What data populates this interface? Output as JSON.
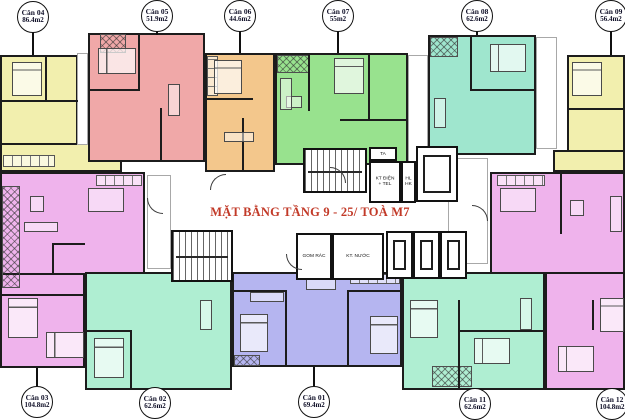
{
  "title": {
    "text": "MẶT BẰNG TẦNG 9 - 25/ TOÀ M7",
    "color": "#c23a28"
  },
  "apartments": [
    {
      "id": "can-04",
      "name": "Căn 04",
      "area": "86.4m2",
      "color": "#f2efae"
    },
    {
      "id": "can-05",
      "name": "Căn 05",
      "area": "51.9m2",
      "color": "#f0a8a8"
    },
    {
      "id": "can-06",
      "name": "Căn 06",
      "area": "44.6m2",
      "color": "#f3c78c"
    },
    {
      "id": "can-07",
      "name": "Căn 07",
      "area": "55m2",
      "color": "#98e28e"
    },
    {
      "id": "can-08",
      "name": "Căn 08",
      "area": "62.6m2",
      "color": "#9fe6ce"
    },
    {
      "id": "can-09",
      "name": "Căn 09",
      "area": "56.4m2",
      "color": "#f2efae"
    },
    {
      "id": "can-03",
      "name": "Căn 03",
      "area": "104.8m2",
      "color": "#efb3ec"
    },
    {
      "id": "can-02",
      "name": "Căn 02",
      "area": "62.6m2",
      "color": "#afeed2"
    },
    {
      "id": "can-01",
      "name": "Căn 01",
      "area": "69.4m2",
      "color": "#b5b5f0"
    },
    {
      "id": "can-11",
      "name": "Căn 11",
      "area": "62.6m2",
      "color": "#afeed2"
    },
    {
      "id": "can-12",
      "name": "Căn 12",
      "area": "104.8m2",
      "color": "#efb3ec"
    }
  ],
  "core": {
    "ta": "TA",
    "kt_dien": "KT ĐIỆN + TEL",
    "hl": "HL",
    "hk": "HK",
    "gom_rac": "GOM RÁC",
    "kt_nuoc": "KT. NƯỚC"
  }
}
